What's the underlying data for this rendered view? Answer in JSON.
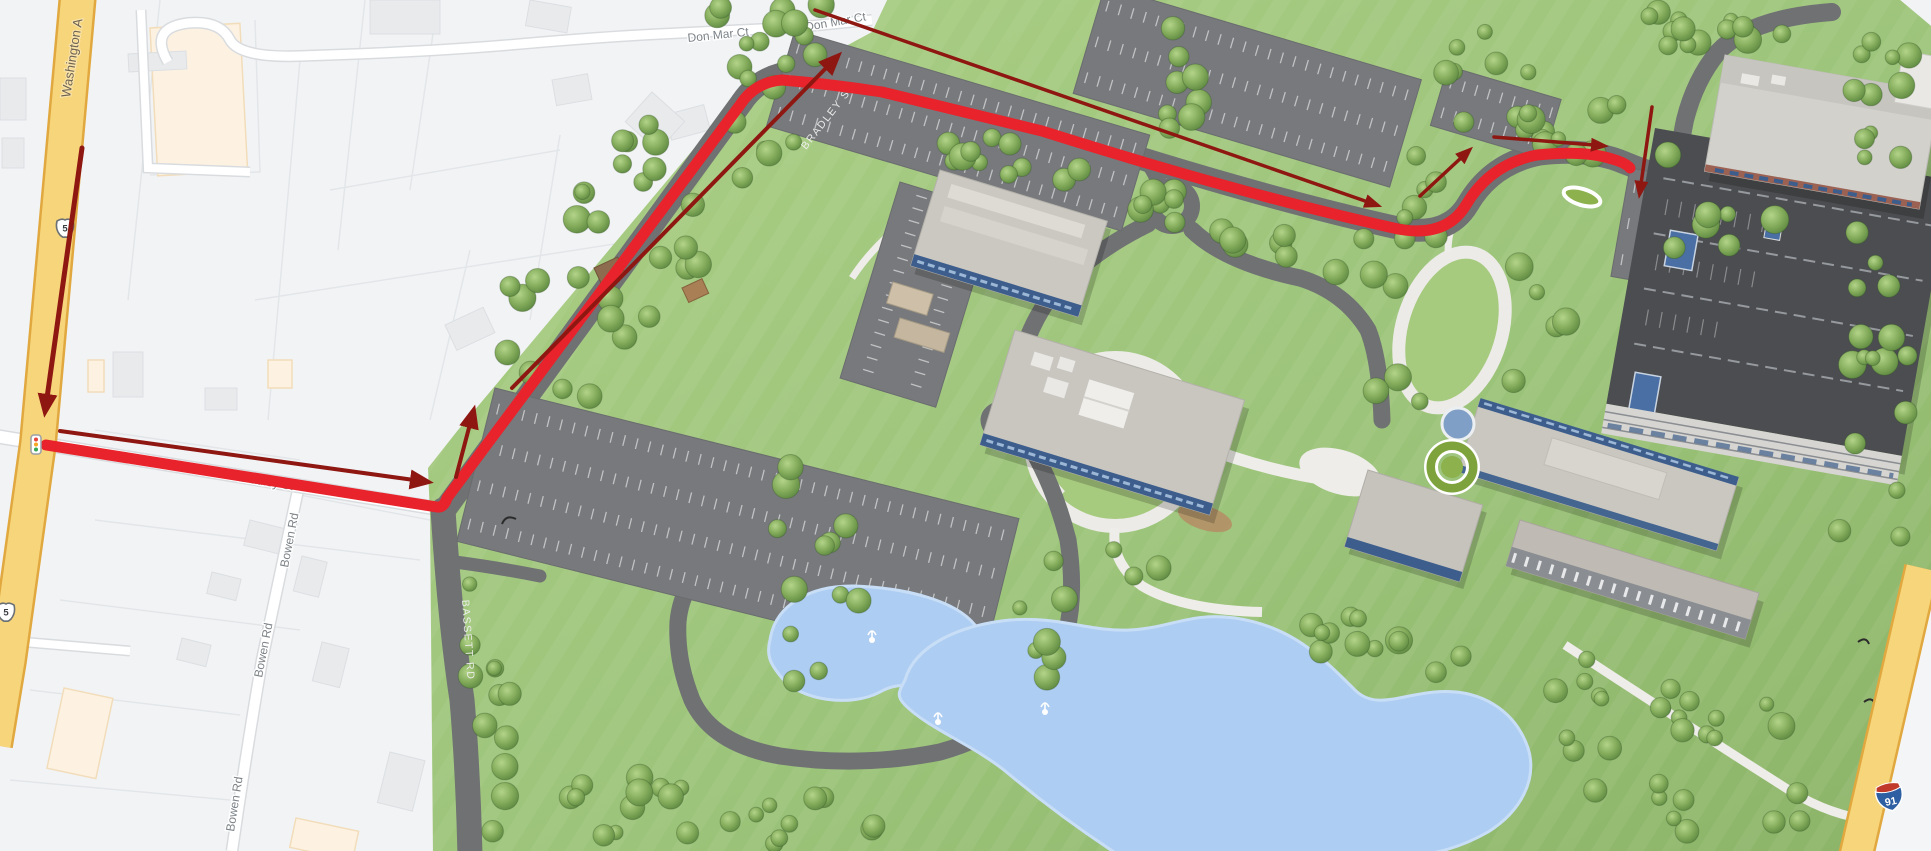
{
  "map": {
    "road_labels": {
      "washington_ave": "Washington A",
      "don_mar_ct": "Don Mar Ct",
      "bradley_st": "Bradley St",
      "bowen_rd": "Bowen Rd",
      "bradley_st_campus": "BRADLEY ST",
      "bassett_rd": "BASSETT RD"
    },
    "shields": {
      "us_route_5": "5",
      "interstate_91": "91"
    },
    "icons": {
      "traffic_light": "traffic-light-icon",
      "fountain": "fountain-icon",
      "route_arrow": "direction-arrow-icon"
    },
    "colors": {
      "route_red": "#e8232b",
      "arrow_dark_red": "#8e1712",
      "highway_yellow": "#f7d57b",
      "highway_border": "#e0a83f",
      "campus_green": "#9cc47a",
      "water_blue": "#aecdf2",
      "road_gray": "#6f7173",
      "parking_gray": "#77797c",
      "garage_dark": "#4b4d50"
    }
  }
}
